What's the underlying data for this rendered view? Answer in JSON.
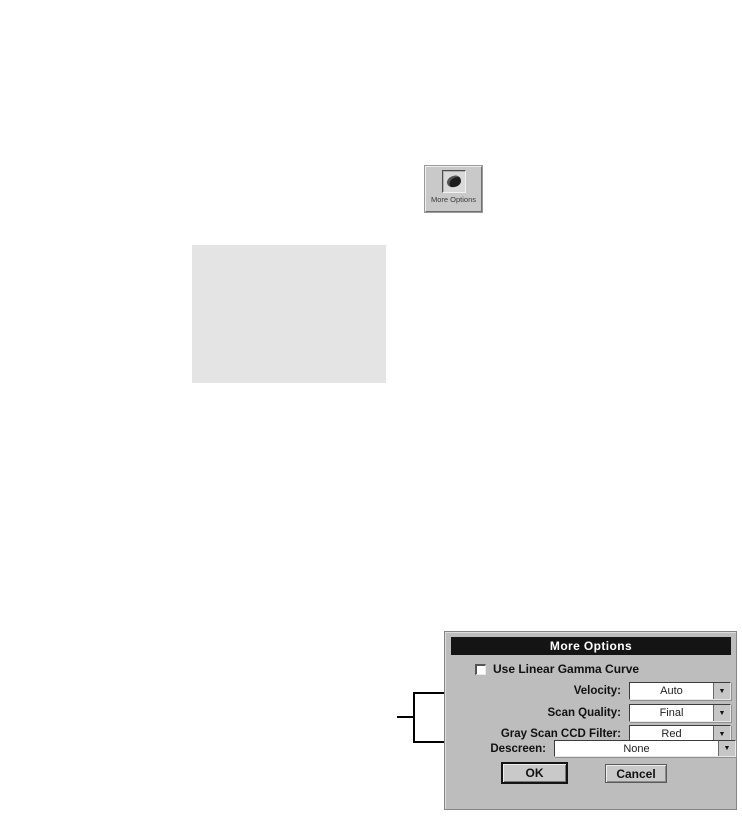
{
  "toolbar_button": {
    "label": "More Options",
    "icon": "more-options-stamp-icon"
  },
  "dialog": {
    "title": "More Options",
    "checkbox": {
      "label": "Use Linear Gamma Curve",
      "checked": false
    },
    "rows": [
      {
        "label": "Velocity:",
        "value": "Auto"
      },
      {
        "label": "Scan Quality:",
        "value": "Final"
      },
      {
        "label": "Gray Scan CCD Filter:",
        "value": "Red"
      },
      {
        "label": "Descreen:",
        "value": "None"
      }
    ],
    "buttons": {
      "ok": "OK",
      "cancel": "Cancel"
    },
    "colors": {
      "titlebar": "#141414",
      "titlebar_text": "#ffffff",
      "body": "#bdbdbd",
      "field": "#ffffff"
    }
  },
  "icons": {
    "dropdown_arrow": "▼"
  },
  "placeholder_box": {
    "color": "#e4e4e4"
  }
}
